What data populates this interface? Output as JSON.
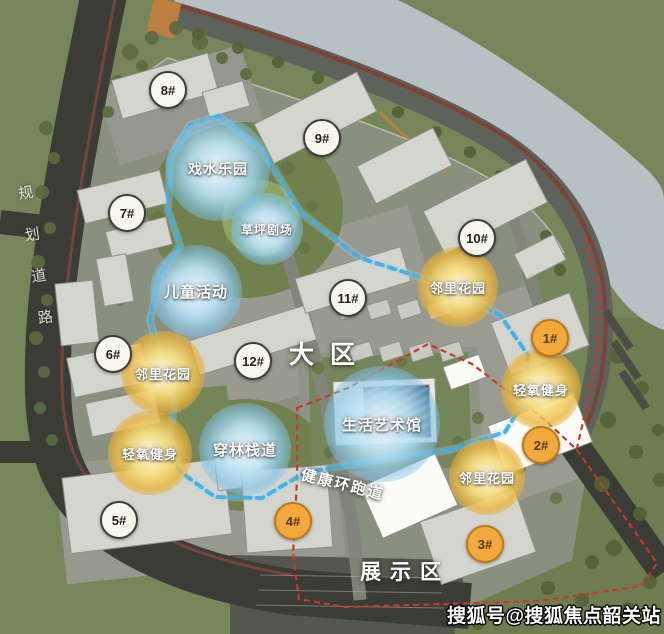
{
  "watermark": "搜狐号@搜狐焦点韶关站",
  "zones": {
    "main_zone": "大区",
    "display_zone": "展示区",
    "track": "健康环跑道",
    "road": "规划道路"
  },
  "features": [
    {
      "label": "戏水乐园",
      "type": "blue"
    },
    {
      "label": "草坪剧场",
      "type": "blue"
    },
    {
      "label": "儿童活动",
      "type": "blue"
    },
    {
      "label": "邻里花园",
      "type": "yellow"
    },
    {
      "label": "轻氧健身",
      "type": "yellow"
    },
    {
      "label": "邻里花园",
      "type": "yellow"
    },
    {
      "label": "轻氧健身",
      "type": "yellow"
    },
    {
      "label": "穿林栈道",
      "type": "blue"
    },
    {
      "label": "生活艺术馆",
      "type": "blue"
    },
    {
      "label": "邻里花园",
      "type": "yellow"
    }
  ],
  "markers": [
    {
      "label": "1#",
      "type": "orange"
    },
    {
      "label": "2#",
      "type": "orange"
    },
    {
      "label": "3#",
      "type": "orange"
    },
    {
      "label": "4#",
      "type": "orange"
    },
    {
      "label": "5#",
      "type": "white"
    },
    {
      "label": "6#",
      "type": "white"
    },
    {
      "label": "7#",
      "type": "white"
    },
    {
      "label": "8#",
      "type": "white"
    },
    {
      "label": "9#",
      "type": "white"
    },
    {
      "label": "10#",
      "type": "white"
    },
    {
      "label": "11#",
      "type": "white"
    },
    {
      "label": "12#",
      "type": "white"
    }
  ],
  "colors": {
    "grass": "#76855a",
    "river": "#b7c1c4",
    "road_dark": "#3b3c36",
    "riverside_red": "#7b443b",
    "boundary_red": "#c23b2e",
    "track_blue": "#45aee3",
    "halo_blue": "#7ec3e6",
    "halo_yellow": "#eec23f",
    "badge_orange": "#f2a93c"
  }
}
